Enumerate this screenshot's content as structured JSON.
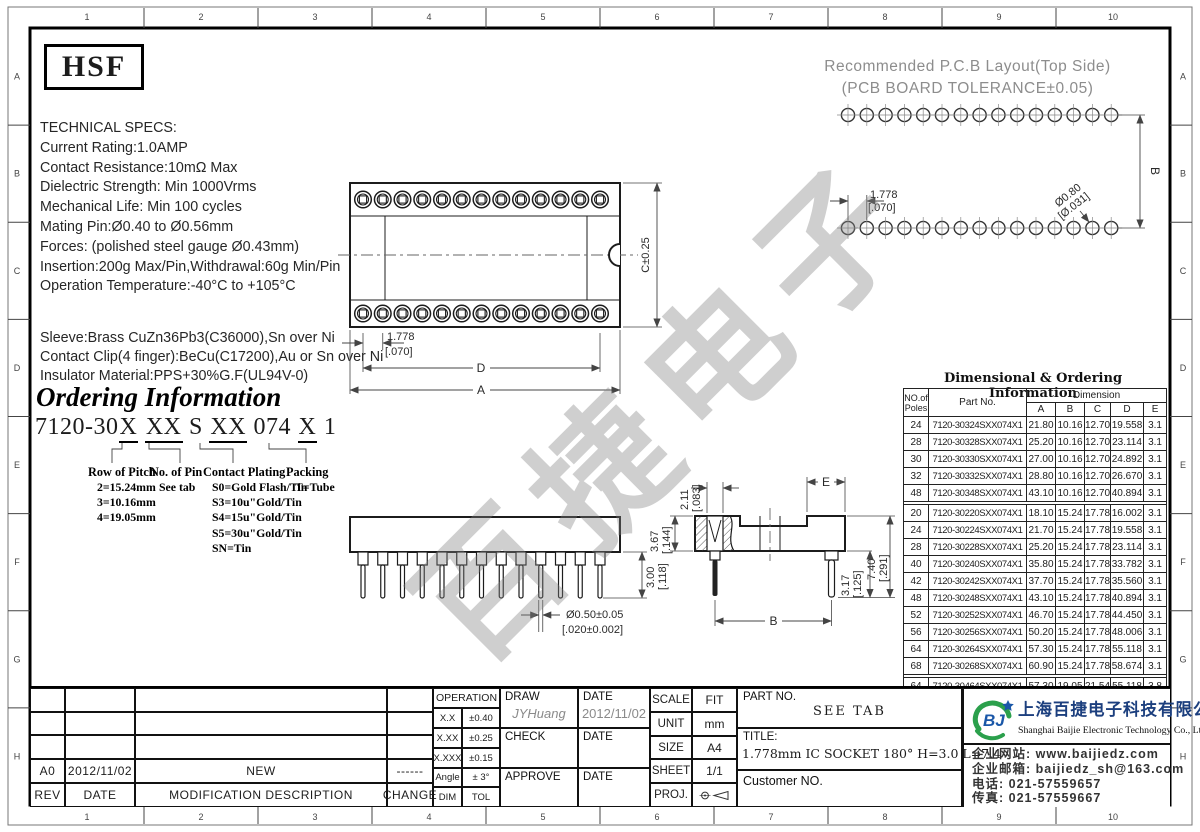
{
  "frame": {
    "top_numbers": [
      "1",
      "2",
      "3",
      "4",
      "5",
      "6",
      "7",
      "8",
      "9",
      "10"
    ],
    "side_letters": [
      "A",
      "B",
      "C",
      "D",
      "E",
      "F",
      "G",
      "H"
    ]
  },
  "brand_mark": "HSF",
  "tech_specs": {
    "title": "TECHNICAL SPECS:",
    "lines": [
      "Current Rating:1.0AMP",
      "Contact Resistance:10mΩ Max",
      "Dielectric Strength: Min 1000Vrms",
      "Mechanical Life: Min 100 cycles",
      "Mating Pin:Ø0.40 to Ø0.56mm",
      "Forces: (polished steel gauge Ø0.43mm)",
      "Insertion:200g Max/Pin,Withdrawal:60g Min/Pin",
      "Operation Temperature:-40°C to +105°C"
    ]
  },
  "materials": {
    "lines": [
      "Sleeve:Brass CuZn36Pb3(C36000),Sn over Ni",
      "Contact Clip(4 finger):BeCu(C17200),Au or Sn over Ni",
      "Insulator Material:PPS+30%G.F(UL94V-0)"
    ]
  },
  "ordering": {
    "title": "Ordering Information",
    "code_segments": [
      {
        "text": "7120-30",
        "underline": false
      },
      {
        "text": "X",
        "underline": true
      },
      {
        "text": " ",
        "underline": false
      },
      {
        "text": "XX",
        "underline": true
      },
      {
        "text": " S ",
        "underline": false
      },
      {
        "text": "XX",
        "underline": true
      },
      {
        "text": " 074 ",
        "underline": false
      },
      {
        "text": "X",
        "underline": true
      },
      {
        "text": " 1",
        "underline": false
      }
    ],
    "groups": [
      {
        "title": "Row of Pitch",
        "lines": [
          "2=15.24mm",
          "3=10.16mm",
          "4=19.05mm"
        ]
      },
      {
        "title": "No. of Pin",
        "lines": [
          "See tab"
        ]
      },
      {
        "title": "Contact Plating",
        "lines": [
          "S0=Gold Flash/Tin",
          "S3=10u\"Gold/Tin",
          "S4=15u\"Gold/Tin",
          "S5=30u\"Gold/Tin",
          "SN=Tin"
        ]
      },
      {
        "title": "Packing",
        "lines": [
          "T=Tube"
        ]
      }
    ]
  },
  "pcb_layout": {
    "title_line1": "Recommended P.C.B Layout(Top Side)",
    "title_line2": "(PCB BOARD TOLERANCE±0.05)",
    "pads_per_row": 15,
    "dim_pitch": "1.778",
    "dim_pitch_in": "[.070]",
    "dim_hole": "Ø0.80",
    "dim_hole_in": "[Ø.031]",
    "dim_span": "B"
  },
  "top_view": {
    "contacts_per_row": 13,
    "dim_pitch": "1.778",
    "dim_pitch_in": "[.070]",
    "dim_height": "C±0.25",
    "dim_d": "D",
    "dim_a": "A"
  },
  "front_view": {
    "pins": 13,
    "dim_pin_len": "3.00",
    "dim_pin_len_in": "[.118]",
    "dim_pin_dia": "Ø0.50±0.05",
    "dim_pin_dia_in": "[.020±0.002]"
  },
  "side_view": {
    "dim_contact": "2.11",
    "dim_contact_in": "[.083]",
    "dim_body": "3.67",
    "dim_body_in": "[.144]",
    "dim_e": "E",
    "dim_total": "7.40",
    "dim_total_in": "[.291]",
    "dim_pin": "3.17",
    "dim_pin_in": "[.125]",
    "dim_b": "B"
  },
  "dim_table": {
    "title": "Dimensional & Ordering Information",
    "col1": "NO.of",
    "col1b": "Poles",
    "col2": "Part No.",
    "dim_header": "Dimension",
    "dim_cols": [
      "A",
      "B",
      "C",
      "D",
      "E"
    ],
    "groups": [
      [
        [
          "24",
          "7120-30324SXX074X1",
          "21.80",
          "10.16",
          "12.70",
          "19.558",
          "3.1"
        ],
        [
          "28",
          "7120-30328SXX074X1",
          "25.20",
          "10.16",
          "12.70",
          "23.114",
          "3.1"
        ],
        [
          "30",
          "7120-30330SXX074X1",
          "27.00",
          "10.16",
          "12.70",
          "24.892",
          "3.1"
        ],
        [
          "32",
          "7120-30332SXX074X1",
          "28.80",
          "10.16",
          "12.70",
          "26.670",
          "3.1"
        ],
        [
          "48",
          "7120-30348SXX074X1",
          "43.10",
          "10.16",
          "12.70",
          "40.894",
          "3.1"
        ]
      ],
      [
        [
          "20",
          "7120-30220SXX074X1",
          "18.10",
          "15.24",
          "17.78",
          "16.002",
          "3.1"
        ],
        [
          "24",
          "7120-30224SXX074X1",
          "21.70",
          "15.24",
          "17.78",
          "19.558",
          "3.1"
        ],
        [
          "28",
          "7120-30228SXX074X1",
          "25.20",
          "15.24",
          "17.78",
          "23.114",
          "3.1"
        ],
        [
          "40",
          "7120-30240SXX074X1",
          "35.80",
          "15.24",
          "17.78",
          "33.782",
          "3.1"
        ],
        [
          "42",
          "7120-30242SXX074X1",
          "37.70",
          "15.24",
          "17.78",
          "35.560",
          "3.1"
        ],
        [
          "48",
          "7120-30248SXX074X1",
          "43.10",
          "15.24",
          "17.78",
          "40.894",
          "3.1"
        ],
        [
          "52",
          "7120-30252SXX074X1",
          "46.70",
          "15.24",
          "17.78",
          "44.450",
          "3.1"
        ],
        [
          "56",
          "7120-30256SXX074X1",
          "50.20",
          "15.24",
          "17.78",
          "48.006",
          "3.1"
        ],
        [
          "64",
          "7120-30264SXX074X1",
          "57.30",
          "15.24",
          "17.78",
          "55.118",
          "3.1"
        ],
        [
          "68",
          "7120-30268SXX074X1",
          "60.90",
          "15.24",
          "17.78",
          "58.674",
          "3.1"
        ]
      ],
      [
        [
          "64",
          "7120-30464SXX074X1",
          "57.30",
          "19.05",
          "21.54",
          "55.118",
          "3.8"
        ]
      ]
    ]
  },
  "revision": {
    "rows": [
      [
        "A0",
        "2012/11/02",
        "NEW",
        "------"
      ]
    ],
    "headers": [
      "REV",
      "DATE",
      "MODIFICATION DESCRIPTION",
      "CHANGE"
    ]
  },
  "tolerance": {
    "header": "OPERATION",
    "rows": [
      [
        "X.X",
        "±0.40"
      ],
      [
        "X.XX",
        "±0.25"
      ],
      [
        "X.XXX",
        "±0.15"
      ],
      [
        "Angle",
        "± 3°"
      ],
      [
        "DIM",
        "TOL"
      ]
    ]
  },
  "signoff": {
    "draw_label": "DRAW",
    "draw_name": "JYHuang",
    "date_label": "DATE",
    "draw_date": "2012/11/02",
    "check_label": "CHECK",
    "approve_label": "APPROVE"
  },
  "sheet_info": {
    "rows": [
      [
        "SCALE",
        "FIT"
      ],
      [
        "UNIT",
        "mm"
      ],
      [
        "SIZE",
        "A4"
      ],
      [
        "SHEET",
        "1/1"
      ]
    ],
    "proj_label": "PROJ."
  },
  "part_info": {
    "part_no_label": "PART NO.",
    "part_no": "SEE TAB",
    "title_label": "TITLE:",
    "title": "1.778mm IC SOCKET 180° H=3.0 L=7.4",
    "customer_label": "Customer NO."
  },
  "company": {
    "logo_text": "BJ",
    "name_cn": "上海百捷电子科技有限公司",
    "name_en": "Shanghai Baijie Electronic Technology Co., Ltd",
    "contact_lines": [
      "企业网站: www.baijiedz.com",
      "企业邮箱: baijiedz_sh@163.com",
      "电话: 021-57559657",
      "传真: 021-57559667"
    ]
  },
  "watermark": "百捷电子"
}
